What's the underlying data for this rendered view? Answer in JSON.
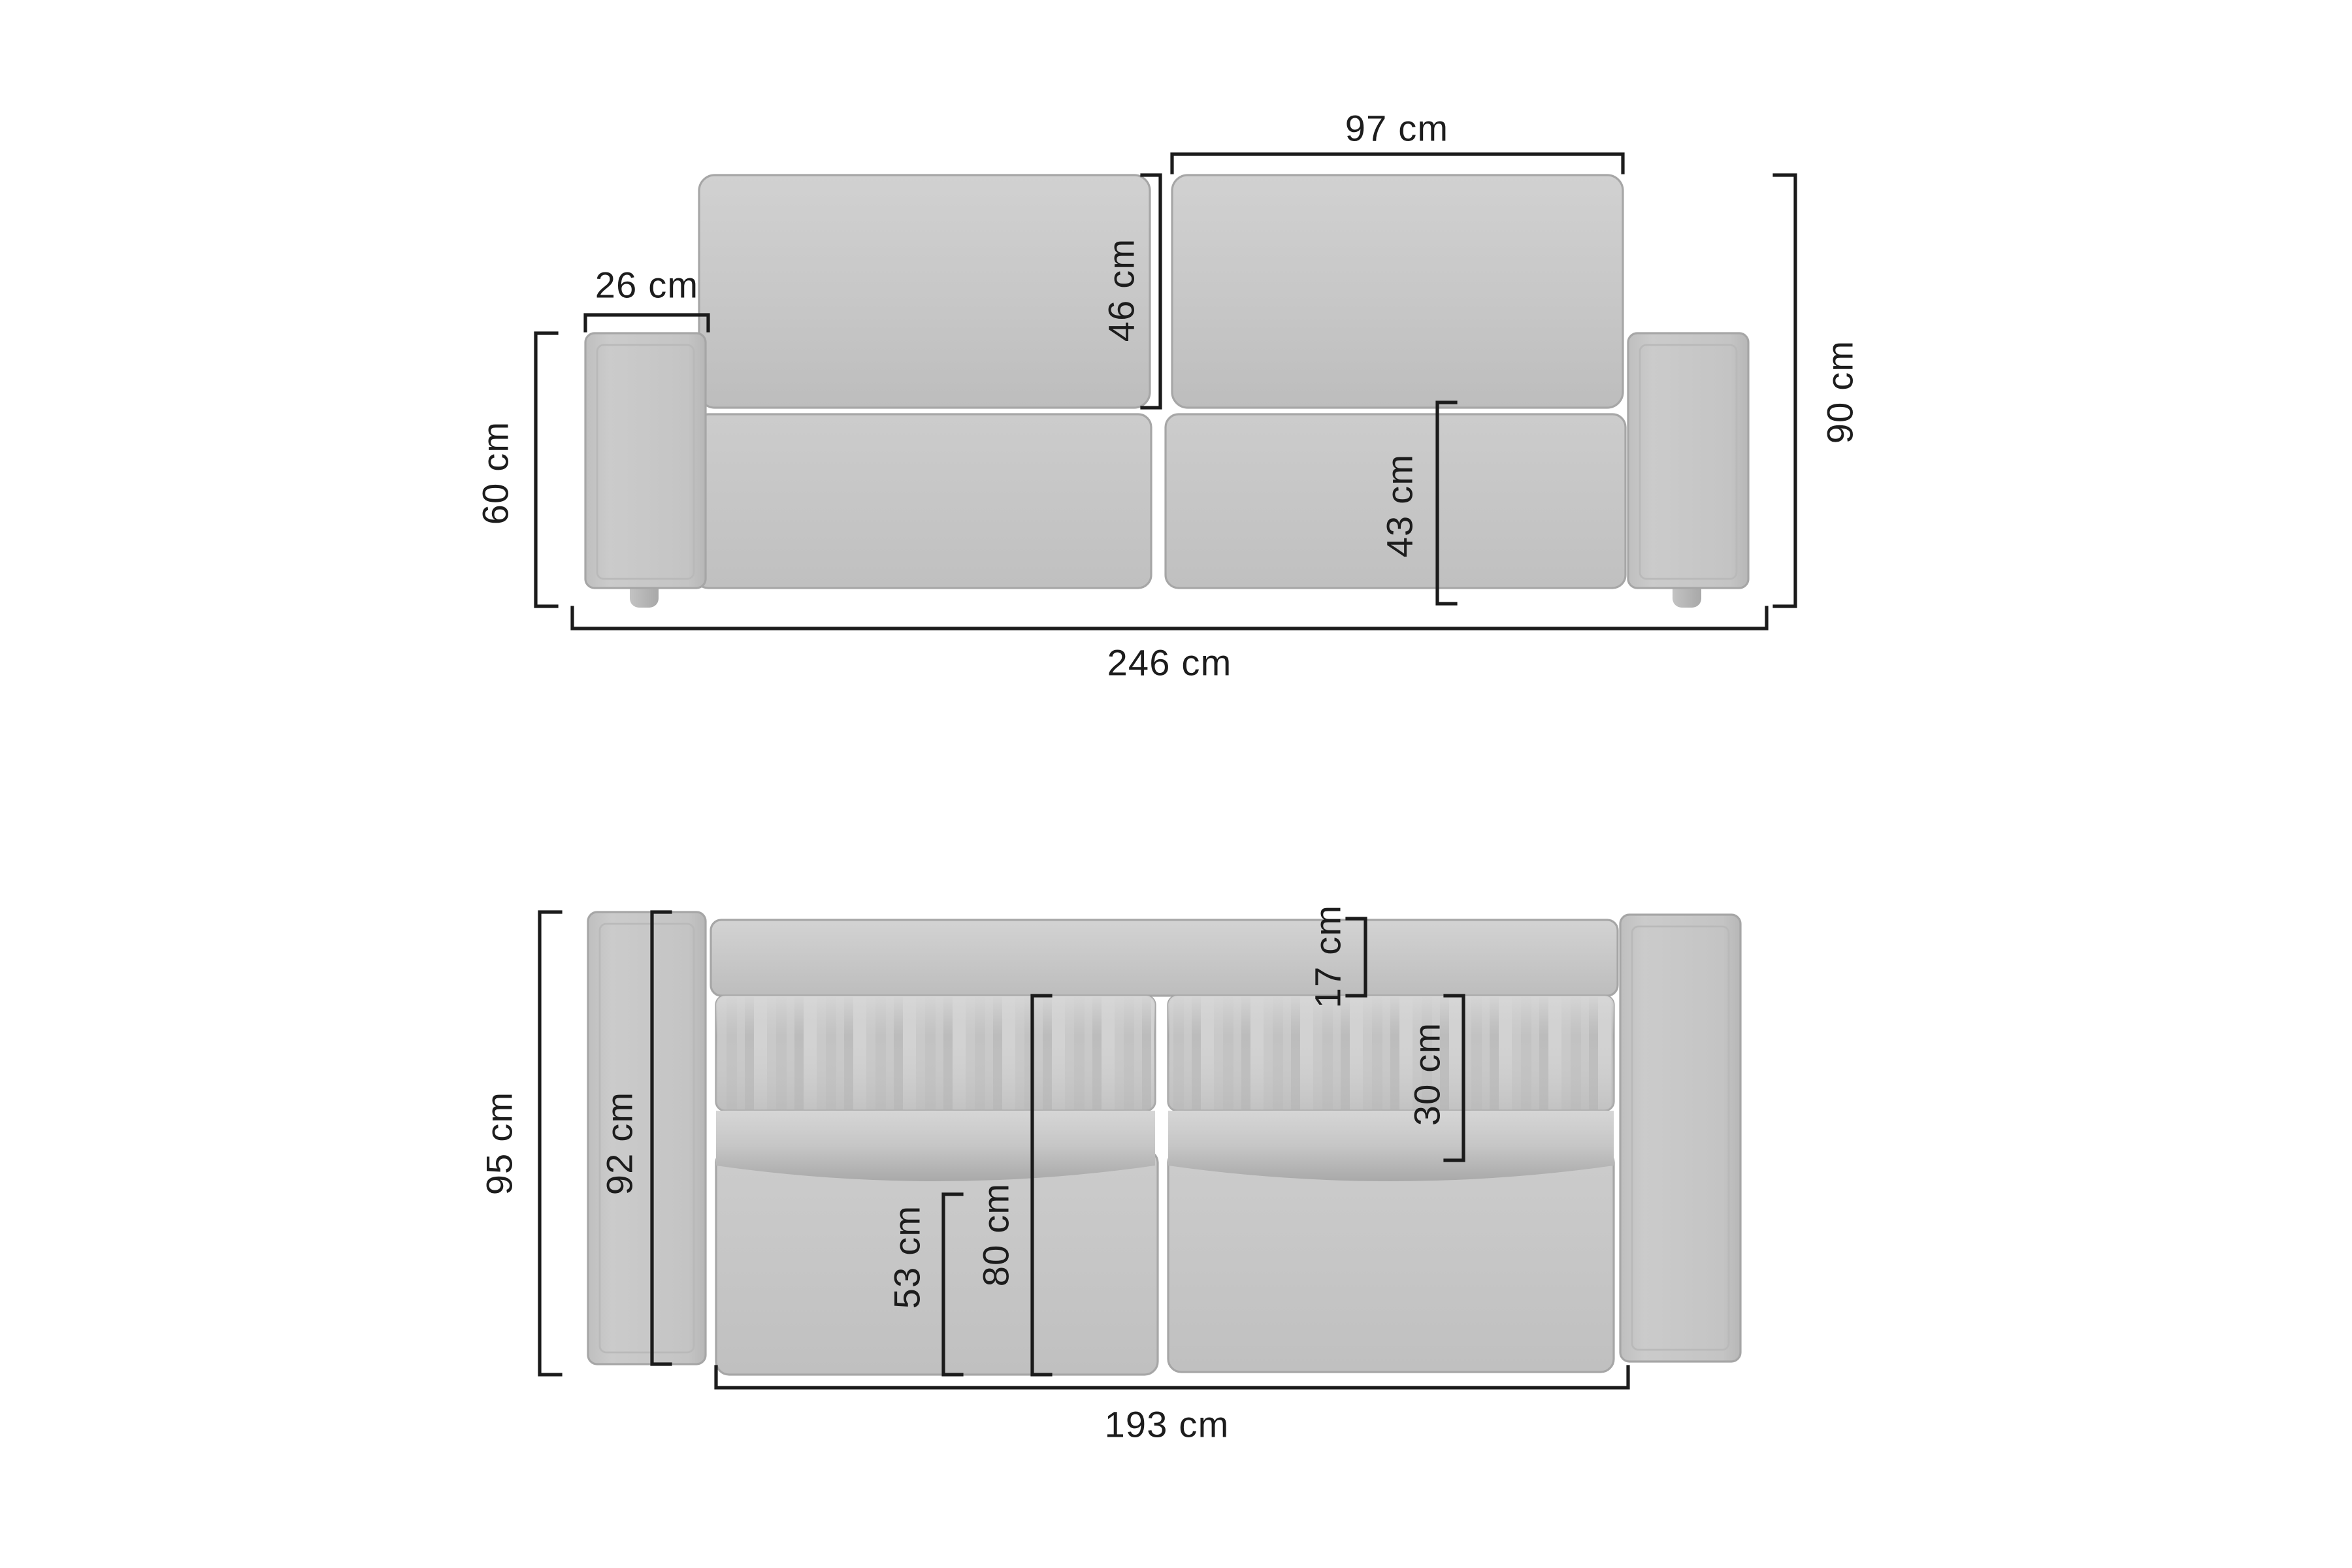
{
  "diagram_title": "Sofa dimensions drawing",
  "unit": "cm",
  "front_view": {
    "name": "front elevation",
    "labels": {
      "back_cushion_width": "97 cm",
      "arm_width": "26 cm",
      "backrest_cushion_height": "46 cm",
      "overall_height": "90 cm",
      "arm_height": "60 cm",
      "seat_height": "43 cm",
      "overall_width": "246 cm"
    }
  },
  "top_view": {
    "name": "top plan",
    "labels": {
      "back_rail_depth": "17 cm",
      "back_cushion_depth": "30 cm",
      "overall_depth": "95 cm",
      "arm_depth": "92 cm",
      "seat_clear_depth": "53 cm",
      "inner_depth": "80 cm",
      "inner_width": "193 cm"
    }
  },
  "colors": {
    "background": "#ffffff",
    "sofa_fill": "#c7c7c7",
    "sofa_fill_light": "#d3d3d3",
    "sofa_fill_dark": "#adadad",
    "fold_shadow": "#8f8f8f",
    "outline": "#a6a6a6",
    "dimension_line": "#1b1b1b",
    "label_text": "#1c1c1c"
  }
}
